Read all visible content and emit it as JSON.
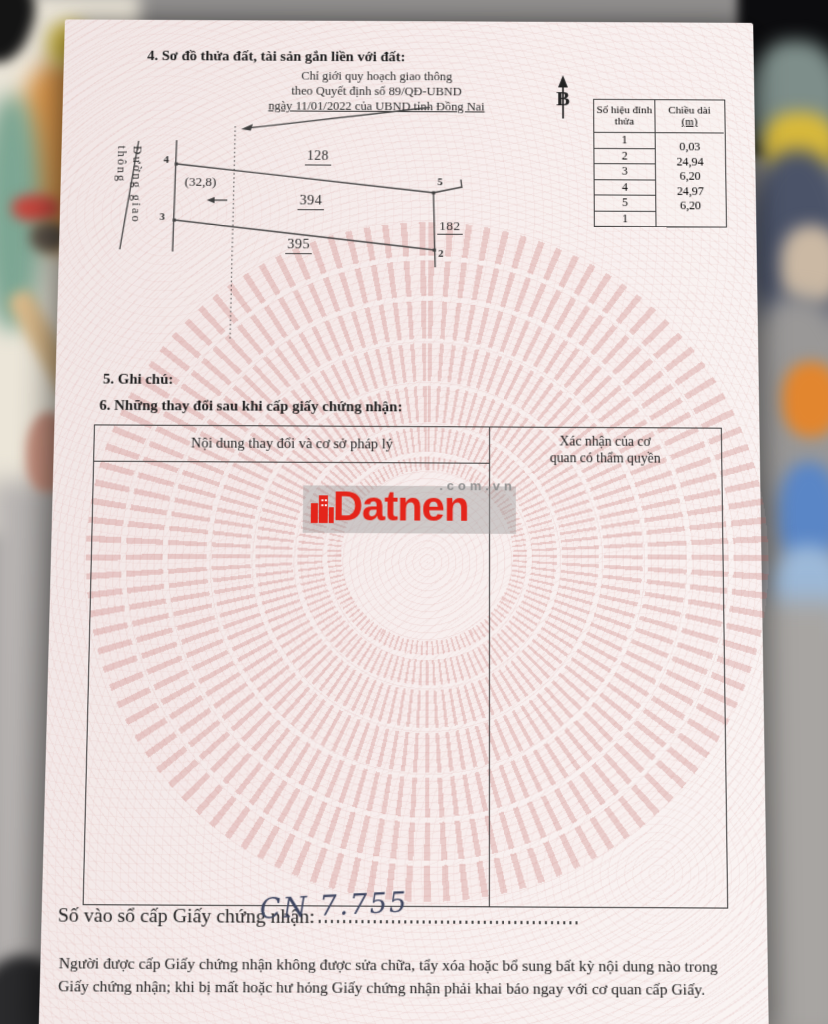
{
  "page": {
    "section4_title": "4. Sơ đồ thửa đất, tài sản gắn liền với đất:",
    "planning_note_line1": "Chỉ giới quy hoạch giao thông",
    "planning_note_line2": "theo Quyết định số 89/QĐ-UBND",
    "planning_note_line3": "ngày 11/01/2022 của UBND tỉnh Đồng Nai",
    "north_label": "B",
    "section5_title": "5. Ghi chú:",
    "section6_title": "6. Những thay đổi sau khi cấp giấy chứng nhận:",
    "registry_label": "Số vào sổ cấp Giấy chứng nhận:",
    "registry_number_handwritten": "CN 7.755",
    "footer_line1": "Người được cấp Giấy chứng nhận không được sửa chữa, tẩy xóa hoặc bổ sung bất kỳ nội dung nào trong",
    "footer_line2": "Giấy chứng nhận; khi bị mất hoặc hư hỏng Giấy chứng nhận phải khai báo ngay với cơ quan cấp Giấy."
  },
  "vertex_table": {
    "col1_header": "Số hiệu đỉnh thửa",
    "col2_header_line1": "Chiều dài",
    "col2_header_line2": "(m)",
    "vertices": [
      "1",
      "2",
      "3",
      "4",
      "5",
      "1"
    ],
    "lengths": [
      "0,03",
      "24,94",
      "6,20",
      "24,97",
      "6,20"
    ]
  },
  "diagram": {
    "road_label": "Đường giao thông",
    "edge_top": "128",
    "edge_middle": "394",
    "edge_bottom": "395",
    "edge_right": "182",
    "offset_label": "(32,8)",
    "point_4": "4",
    "point_3": "3",
    "point_5": "5",
    "point_2": "2"
  },
  "changes_table": {
    "col1_header": "Nội dung thay đổi và cơ sở pháp lý",
    "col2_header_line1": "Xác nhận của cơ",
    "col2_header_line2": "quan có thẩm quyền"
  },
  "watermark": {
    "brand": "Datnen",
    "suffix": ".com.vn",
    "brand_color": "#e4251b"
  },
  "colors": {
    "paper_pink": "#f7efee",
    "drum_pattern_pink": "#c97a76",
    "ink_handwriting": "#3f4660"
  }
}
